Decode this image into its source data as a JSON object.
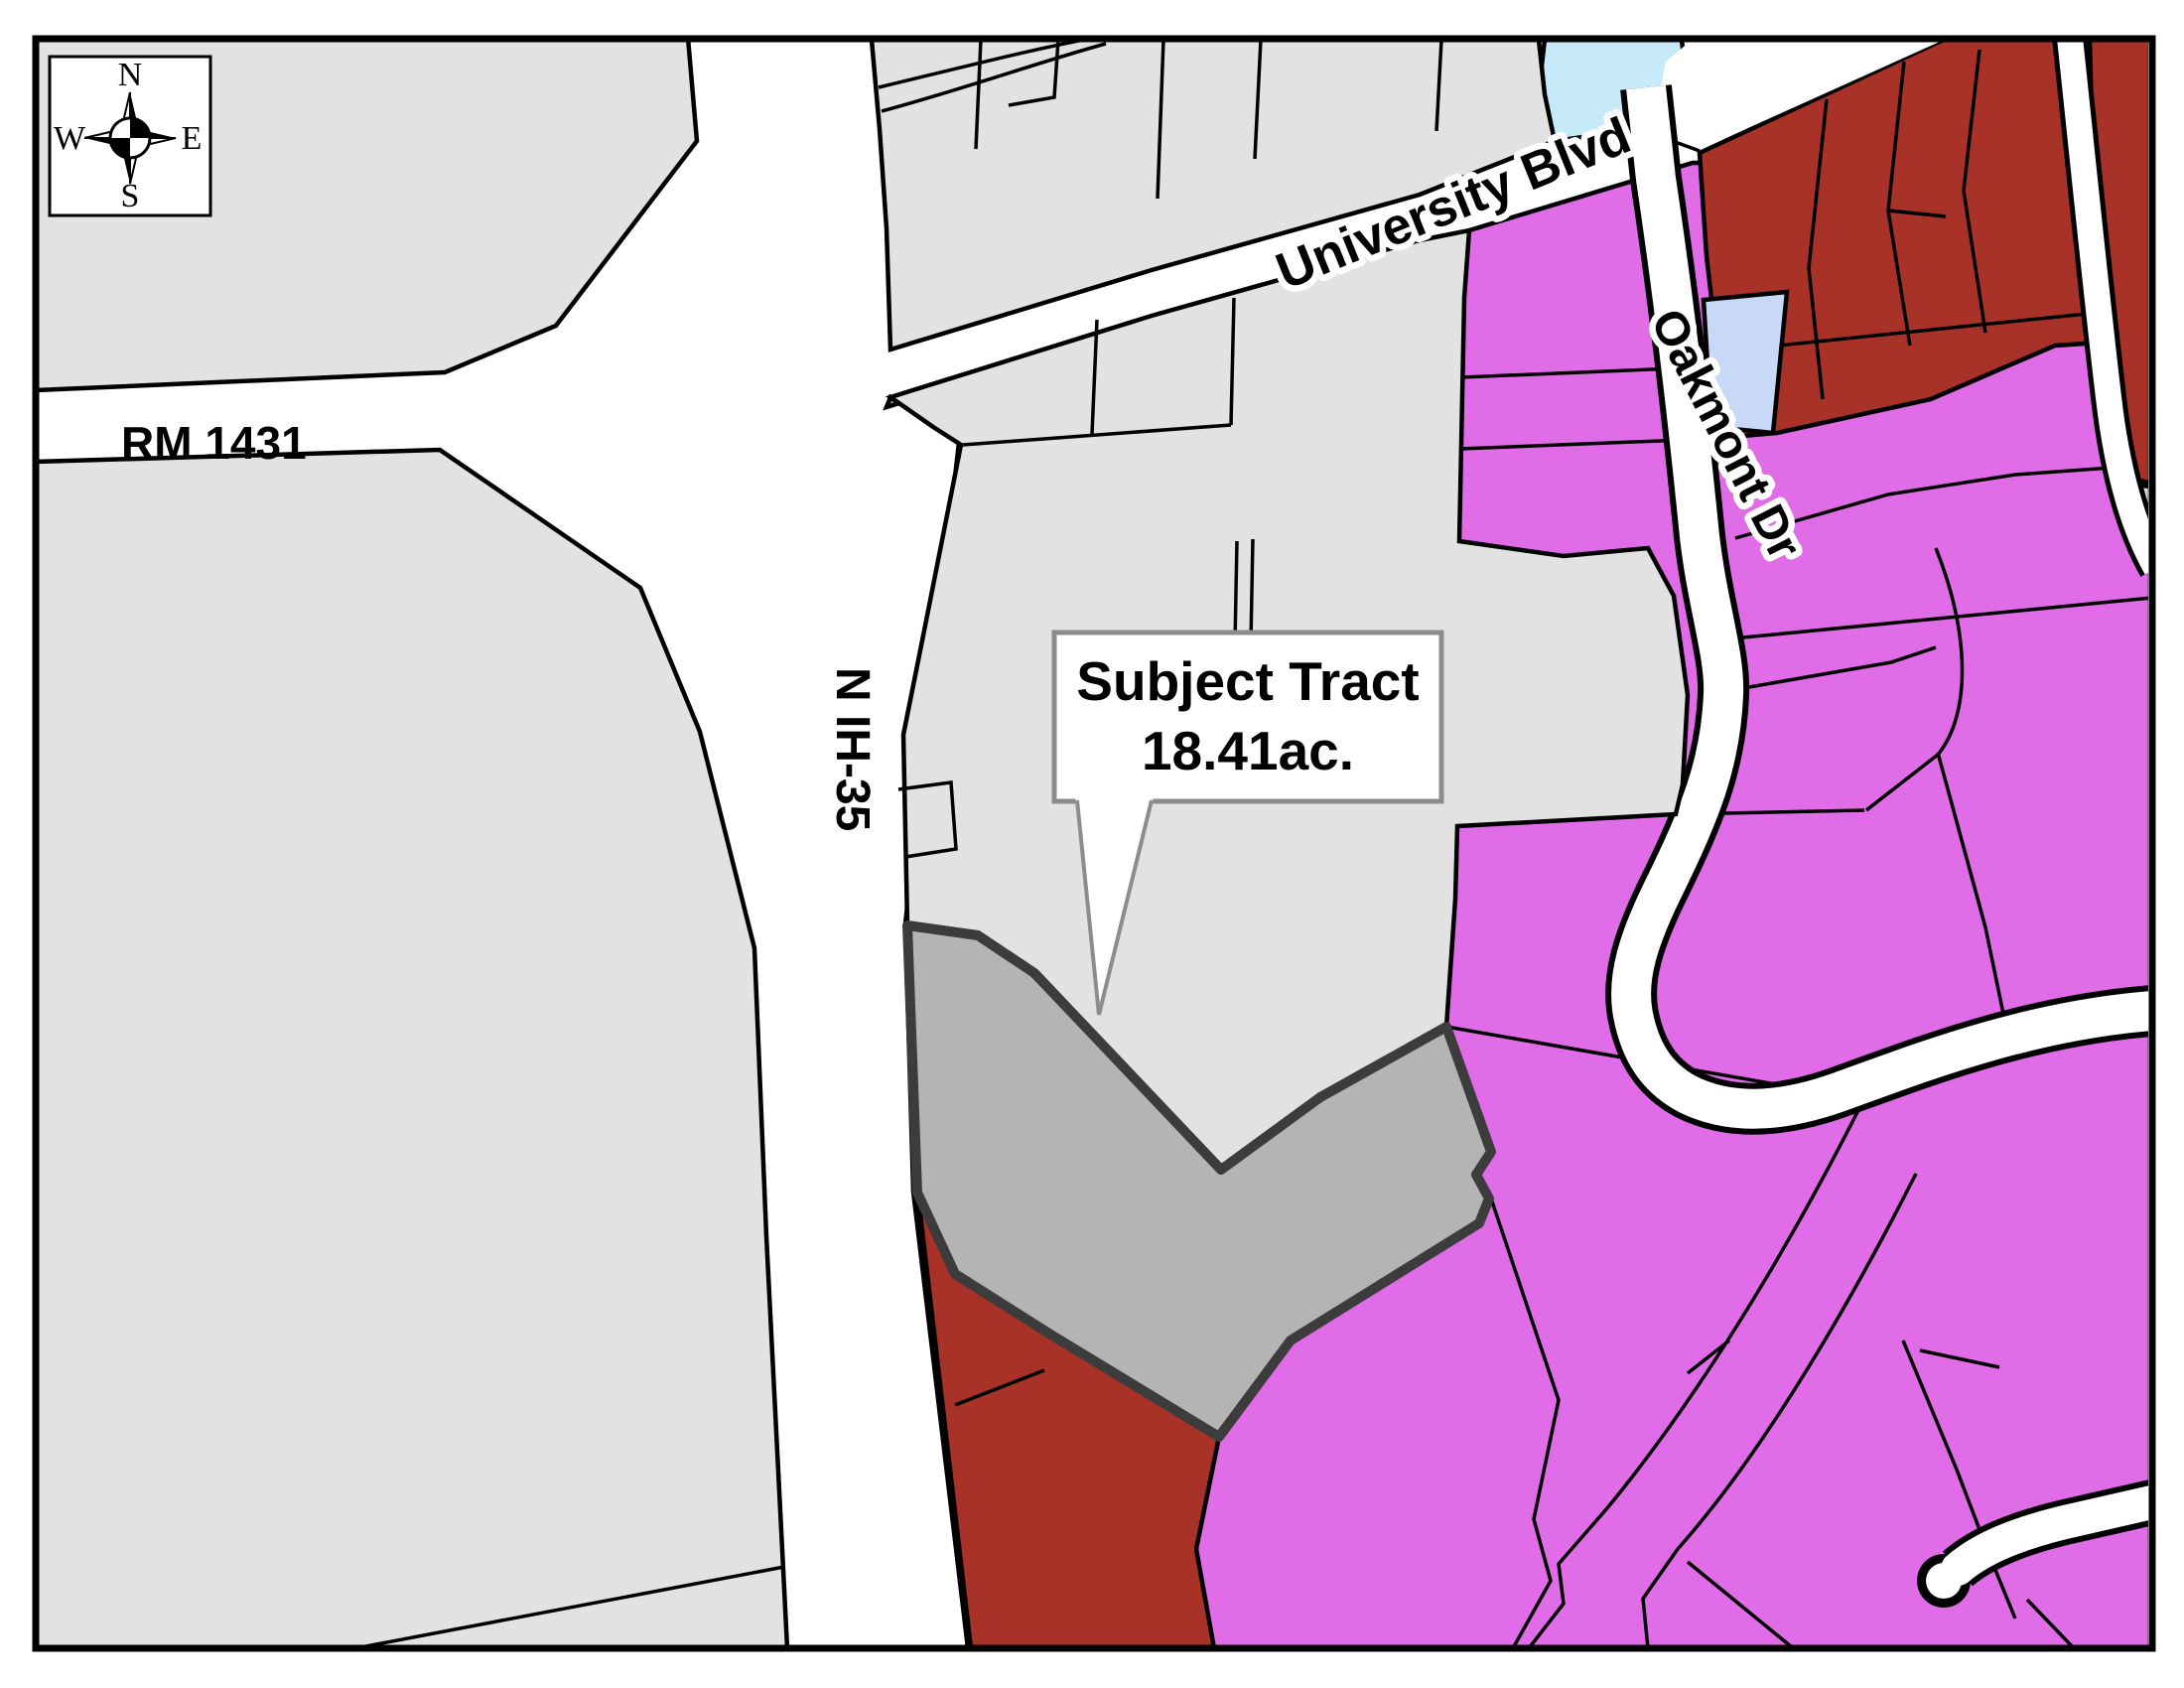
{
  "map": {
    "title": "Zoning location map",
    "labels": {
      "road_rm": "RM 1431",
      "road_ih": "N IH-35",
      "road_university": "University Blvd",
      "road_oakmont": "Oakmont Dr"
    },
    "callout": {
      "line1": "Subject Tract",
      "line2": "18.41ac.",
      "area_acres": "18.41"
    },
    "compass": {
      "n": "N",
      "s": "S",
      "e": "E",
      "w": "W"
    },
    "colors": {
      "parcel_gray": "#E2E2E2",
      "subject_tract": "#B4B4B4",
      "subject_tract_border": "#3C3C3C",
      "residential_magenta": "#E06CE8",
      "commercial_red": "#A83228",
      "water_blue": "#C7EAF8",
      "parcel_lavender": "#C8D8F7",
      "parcel_gray_light": "#D9D9D9",
      "road_white": "#FFFFFF",
      "line_black": "#000000",
      "callout_border": "#8C8C8C"
    }
  }
}
